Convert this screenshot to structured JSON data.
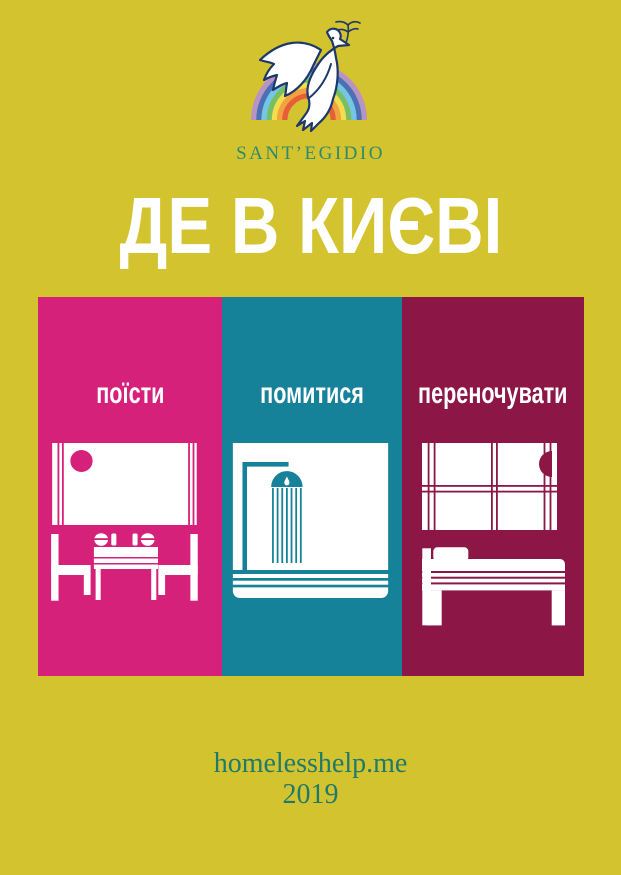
{
  "page": {
    "background_color": "#d3c32f"
  },
  "logo": {
    "org_name": "SANT’EGIDIO",
    "icon": "dove-with-olive-branch-over-rainbow-icon",
    "text_color": "#2e8a6d",
    "outline_color": "#1d3869",
    "rainbow_colors": [
      "#b992c6",
      "#4a71b8",
      "#74c6e8",
      "#77bf66",
      "#f2dd4e",
      "#f2a33f",
      "#e75f38"
    ]
  },
  "title": {
    "text": "ДЕ В КИЄВІ",
    "color": "#ffffff"
  },
  "panels": [
    {
      "label": "поїсти",
      "color": "#d6217b",
      "icon": "dining-table-icon"
    },
    {
      "label": "помитися",
      "color": "#16829a",
      "icon": "shower-icon"
    },
    {
      "label": "переночувати",
      "color": "#8c1746",
      "icon": "bed-icon"
    }
  ],
  "footer": {
    "website": "homelesshelp.me",
    "year": "2019",
    "color": "#1f7a6b"
  }
}
